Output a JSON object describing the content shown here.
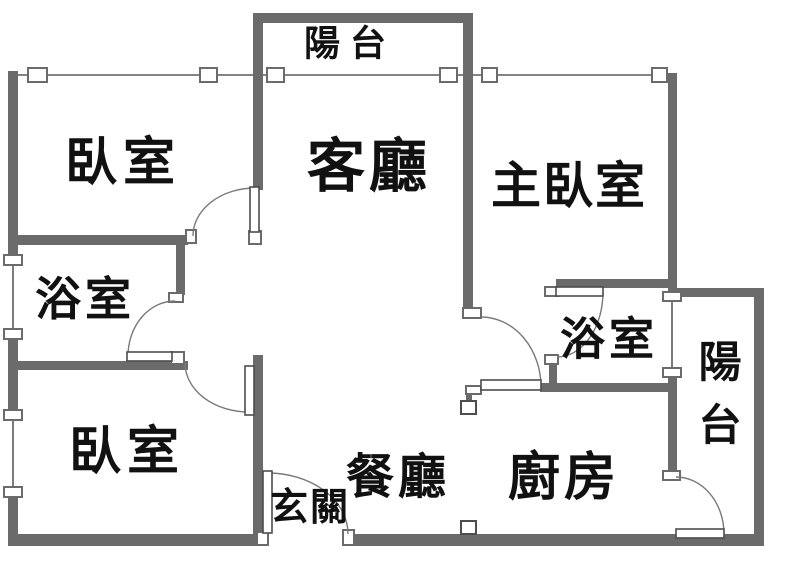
{
  "title": "apartment-floor-plan",
  "colors": {
    "background": "#ffffff",
    "wall": "#6b6b6b",
    "window_line": "#5a5a5a",
    "arc": "#7a7a7a",
    "leaf_border": "#4d4d4d",
    "box_border": "#6b6b6b",
    "marker_border": "#4d4d4d",
    "text": "#111111"
  },
  "canvas": {
    "width": 800,
    "height": 576
  },
  "walls": [
    {
      "name": "wall-balcony-top",
      "x": 253,
      "y": 13,
      "w": 219,
      "h": 10
    },
    {
      "name": "wall-bedroom1-living",
      "x": 253,
      "y": 13,
      "w": 10,
      "h": 177
    },
    {
      "name": "wall-living-master",
      "x": 463,
      "y": 13,
      "w": 10,
      "h": 297
    },
    {
      "name": "wall-left-upper",
      "x": 8,
      "y": 71,
      "w": 10,
      "h": 185
    },
    {
      "name": "wall-left-mid",
      "x": 8,
      "y": 338,
      "w": 10,
      "h": 73
    },
    {
      "name": "wall-left-lower",
      "x": 8,
      "y": 497,
      "w": 10,
      "h": 49
    },
    {
      "name": "wall-bath1-north",
      "x": 8,
      "y": 235,
      "w": 180,
      "h": 10
    },
    {
      "name": "wall-bath1-east",
      "x": 176,
      "y": 243,
      "w": 9,
      "h": 52
    },
    {
      "name": "wall-bath1-south",
      "x": 8,
      "y": 361,
      "w": 180,
      "h": 9
    },
    {
      "name": "wall-bedroom2-east",
      "x": 253,
      "y": 355,
      "w": 10,
      "h": 180
    },
    {
      "name": "wall-bottom-left",
      "x": 8,
      "y": 534,
      "w": 259,
      "h": 12
    },
    {
      "name": "wall-bottom-right",
      "x": 346,
      "y": 534,
      "w": 418,
      "h": 12
    },
    {
      "name": "wall-right-exterior",
      "x": 754,
      "y": 290,
      "w": 10,
      "h": 256
    },
    {
      "name": "wall-master-east",
      "x": 668,
      "y": 73,
      "w": 9,
      "h": 222
    },
    {
      "name": "wall-balcony2-north",
      "x": 672,
      "y": 288,
      "w": 92,
      "h": 9
    },
    {
      "name": "wall-bath2-north",
      "x": 556,
      "y": 279,
      "w": 120,
      "h": 9
    },
    {
      "name": "wall-bath2-south",
      "x": 540,
      "y": 383,
      "w": 136,
      "h": 9
    },
    {
      "name": "wall-bath2-west-stub",
      "x": 549,
      "y": 363,
      "w": 8,
      "h": 22
    },
    {
      "name": "wall-balcony2-west",
      "x": 668,
      "y": 376,
      "w": 9,
      "h": 96
    }
  ],
  "windows": [
    {
      "name": "window-bedroom1-north",
      "line": [
        18,
        75,
        253,
        75
      ],
      "boxes": [
        [
          28,
          68,
          19,
          14
        ],
        [
          200,
          68,
          17,
          14
        ]
      ]
    },
    {
      "name": "window-balcony-slider",
      "line": [
        263,
        75,
        463,
        75
      ],
      "boxes": [
        [
          267,
          68,
          17,
          14
        ],
        [
          440,
          68,
          17,
          14
        ]
      ]
    },
    {
      "name": "window-master-north",
      "line": [
        473,
        75,
        668,
        75
      ],
      "boxes": [
        [
          482,
          68,
          15,
          14
        ],
        [
          652,
          68,
          15,
          14
        ]
      ]
    },
    {
      "name": "window-bath1-west",
      "line": [
        13,
        256,
        13,
        334
      ],
      "boxes": [
        [
          4,
          255,
          18,
          10
        ],
        [
          4,
          329,
          18,
          10
        ]
      ]
    },
    {
      "name": "window-bedroom2-west",
      "line": [
        13,
        419,
        13,
        492
      ],
      "boxes": [
        [
          4,
          410,
          18,
          10
        ],
        [
          4,
          487,
          18,
          10
        ]
      ]
    },
    {
      "name": "window-bath2-balcony",
      "line": [
        672,
        300,
        672,
        371
      ],
      "boxes": [
        [
          663,
          292,
          18,
          9
        ],
        [
          663,
          368,
          18,
          9
        ]
      ]
    }
  ],
  "jambs": [
    {
      "name": "jamb-bedroom1-left",
      "x": 186,
      "y": 230,
      "w": 10,
      "h": 13
    },
    {
      "name": "jamb-bedroom1-hinge",
      "x": 249,
      "y": 231,
      "w": 12,
      "h": 13
    },
    {
      "name": "jamb-bath1-top",
      "x": 169,
      "y": 293,
      "w": 14,
      "h": 9
    },
    {
      "name": "jamb-bath1-bottom",
      "x": 171,
      "y": 352,
      "w": 13,
      "h": 12
    },
    {
      "name": "jamb-entry-hinge",
      "x": 257,
      "y": 532,
      "w": 11,
      "h": 13
    },
    {
      "name": "jamb-entry-right",
      "x": 343,
      "y": 530,
      "w": 11,
      "h": 15
    },
    {
      "name": "jamb-kitchen-top",
      "x": 463,
      "y": 308,
      "w": 18,
      "h": 10
    },
    {
      "name": "jamb-kitchen-hinge",
      "x": 466,
      "y": 386,
      "w": 15,
      "h": 8
    },
    {
      "name": "jamb-bath2-left",
      "x": 545,
      "y": 287,
      "w": 13,
      "h": 9
    },
    {
      "name": "jamb-bath2-bottom",
      "x": 545,
      "y": 355,
      "w": 13,
      "h": 9
    },
    {
      "name": "jamb-balcony2-top",
      "x": 663,
      "y": 471,
      "w": 17,
      "h": 9
    }
  ],
  "doors": [
    {
      "name": "door-bedroom1",
      "leaf": [
        250,
        187,
        9,
        45
      ],
      "arc": "M193,236 A62,48 0 0 1 255,188"
    },
    {
      "name": "door-bath1",
      "leaf": [
        127,
        352,
        45,
        9
      ],
      "arc": "M128,356 A47,55 0 0 1 175,301"
    },
    {
      "name": "door-bedroom2",
      "leaf": [
        245,
        366,
        9,
        49
      ],
      "arc": "M249,412 A64,49 0 0 1 185,363"
    },
    {
      "name": "door-entry",
      "leaf": [
        263,
        471,
        9,
        62
      ],
      "arc": "M268,473 A80,61 0 0 1 348,534"
    },
    {
      "name": "door-kitchen",
      "leaf": [
        481,
        380,
        60,
        10
      ],
      "arc": "M481,317 A60,70 0 0 1 541,387"
    },
    {
      "name": "door-bath2",
      "leaf": [
        556,
        287,
        47,
        9
      ],
      "arc": "M603,292 A46,65 0 0 1 557,357"
    },
    {
      "name": "door-balcony2",
      "leaf": [
        676,
        529,
        48,
        9
      ],
      "arc": "M676,477 A48,57 0 0 1 724,534"
    }
  ],
  "markers": [
    {
      "name": "column-marker-upper",
      "box": [
        461,
        401,
        15,
        13
      ],
      "stub": [
        466,
        394,
        6,
        8
      ]
    },
    {
      "name": "column-marker-lower",
      "box": [
        461,
        521,
        15,
        13
      ],
      "stub": [
        466,
        533,
        6,
        4
      ]
    }
  ],
  "labels": [
    {
      "name": "room-label-balcony-top",
      "text": "陽台",
      "x": 350,
      "y": 44,
      "size": 36,
      "spacing": 10
    },
    {
      "name": "room-label-bedroom1",
      "text": "臥室",
      "x": 123,
      "y": 163,
      "size": 52,
      "spacing": 6
    },
    {
      "name": "room-label-living",
      "text": "客廳",
      "x": 369,
      "y": 166,
      "size": 58,
      "spacing": 4
    },
    {
      "name": "room-label-master",
      "text": "主臥室",
      "x": 569,
      "y": 186,
      "size": 50,
      "spacing": 2
    },
    {
      "name": "room-label-bath1",
      "text": "浴室",
      "x": 85,
      "y": 299,
      "size": 46,
      "spacing": 4
    },
    {
      "name": "room-label-bath2",
      "text": "浴室",
      "x": 609,
      "y": 339,
      "size": 45,
      "spacing": 4
    },
    {
      "name": "room-label-bedroom2",
      "text": "臥室",
      "x": 127,
      "y": 452,
      "size": 52,
      "spacing": 6
    },
    {
      "name": "room-label-entry",
      "text": "玄關",
      "x": 310,
      "y": 507,
      "size": 38,
      "spacing": 2
    },
    {
      "name": "room-label-dining",
      "text": "餐廳",
      "x": 398,
      "y": 477,
      "size": 48,
      "spacing": 4
    },
    {
      "name": "room-label-kitchen",
      "text": "廚房",
      "x": 564,
      "y": 478,
      "size": 52,
      "spacing": 4
    },
    {
      "name": "room-label-balcony-right",
      "text": "陽台",
      "x": 720,
      "vertical": true,
      "chars_y": [
        363,
        426
      ],
      "size": 43,
      "spacing": 0
    }
  ]
}
